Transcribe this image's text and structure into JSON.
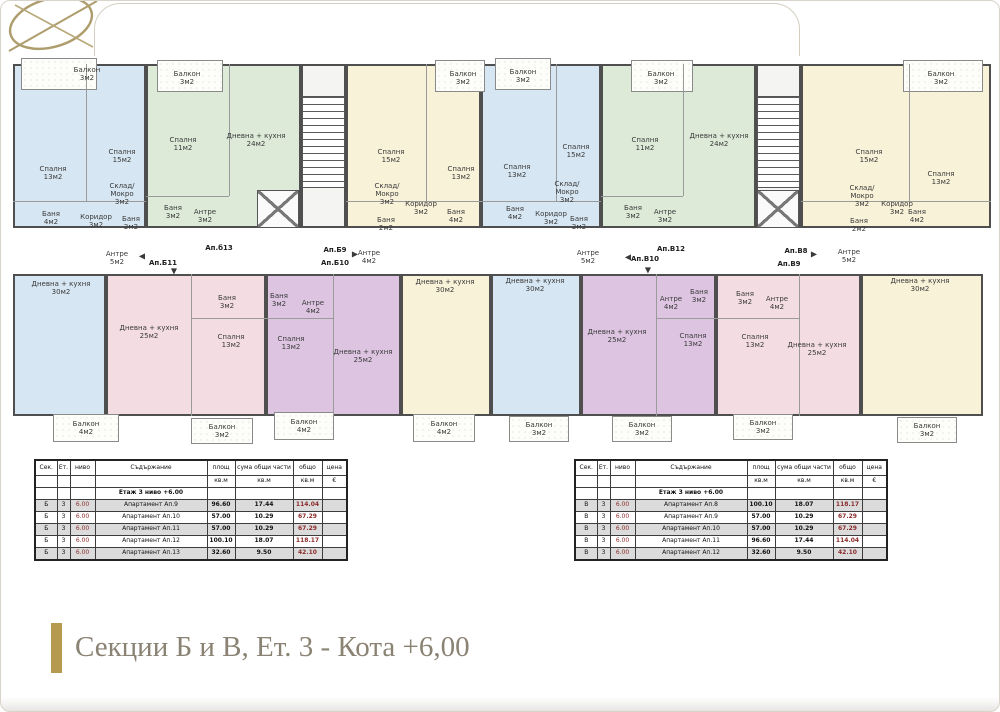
{
  "footer": {
    "title": "Секции Б и В, Ет. 3 - Кота +6,00",
    "accent_gold": "#b69a50"
  },
  "plan": {
    "palette": {
      "blue": "#d6e6f2",
      "green": "#dcead7",
      "yellow": "#f8f2d8",
      "pink": "#f4dde2",
      "purple": "#ddc5e2",
      "wall": "#4f4f4f"
    },
    "blocks": [
      {
        "x": 2,
        "y": 8,
        "w": 133,
        "h": 164,
        "f": "blue"
      },
      {
        "x": 135,
        "y": 8,
        "w": 155,
        "h": 164,
        "f": "green"
      },
      {
        "x": 290,
        "y": 8,
        "w": 45,
        "h": 164,
        "f": "core"
      },
      {
        "x": 335,
        "y": 8,
        "w": 135,
        "h": 164,
        "f": "yellow"
      },
      {
        "x": 470,
        "y": 8,
        "w": 120,
        "h": 164,
        "f": "blue"
      },
      {
        "x": 590,
        "y": 8,
        "w": 155,
        "h": 164,
        "f": "green"
      },
      {
        "x": 745,
        "y": 8,
        "w": 45,
        "h": 164,
        "f": "core"
      },
      {
        "x": 790,
        "y": 8,
        "w": 190,
        "h": 164,
        "f": "yellow"
      },
      {
        "x": 2,
        "y": 218,
        "w": 93,
        "h": 142,
        "f": "blue"
      },
      {
        "x": 95,
        "y": 218,
        "w": 160,
        "h": 142,
        "f": "pink"
      },
      {
        "x": 255,
        "y": 218,
        "w": 135,
        "h": 142,
        "f": "purple"
      },
      {
        "x": 390,
        "y": 218,
        "w": 90,
        "h": 142,
        "f": "yellow"
      },
      {
        "x": 480,
        "y": 218,
        "w": 90,
        "h": 142,
        "f": "blue"
      },
      {
        "x": 570,
        "y": 218,
        "w": 135,
        "h": 142,
        "f": "purple"
      },
      {
        "x": 705,
        "y": 218,
        "w": 145,
        "h": 142,
        "f": "pink"
      },
      {
        "x": 850,
        "y": 218,
        "w": 122,
        "h": 142,
        "f": "yellow"
      }
    ],
    "balconies": [
      {
        "x": 10,
        "y": 2,
        "w": 76,
        "h": 32
      },
      {
        "x": 146,
        "y": 4,
        "w": 66,
        "h": 32
      },
      {
        "x": 424,
        "y": 4,
        "w": 50,
        "h": 32
      },
      {
        "x": 484,
        "y": 2,
        "w": 56,
        "h": 32
      },
      {
        "x": 620,
        "y": 4,
        "w": 62,
        "h": 32
      },
      {
        "x": 892,
        "y": 4,
        "w": 80,
        "h": 32
      },
      {
        "x": 42,
        "y": 358,
        "w": 66,
        "h": 28
      },
      {
        "x": 180,
        "y": 362,
        "w": 62,
        "h": 26
      },
      {
        "x": 263,
        "y": 356,
        "w": 60,
        "h": 28
      },
      {
        "x": 402,
        "y": 358,
        "w": 62,
        "h": 28
      },
      {
        "x": 498,
        "y": 360,
        "w": 60,
        "h": 26
      },
      {
        "x": 601,
        "y": 360,
        "w": 60,
        "h": 26
      },
      {
        "x": 722,
        "y": 358,
        "w": 60,
        "h": 26
      },
      {
        "x": 886,
        "y": 361,
        "w": 60,
        "h": 26
      }
    ],
    "dividers": [
      {
        "x": 75,
        "y": 8,
        "w": 1,
        "h": 137
      },
      {
        "x": 2,
        "y": 145,
        "w": 133,
        "h": 1
      },
      {
        "x": 218,
        "y": 8,
        "w": 1,
        "h": 132
      },
      {
        "x": 135,
        "y": 140,
        "w": 83,
        "h": 1
      },
      {
        "x": 415,
        "y": 8,
        "w": 1,
        "h": 137
      },
      {
        "x": 335,
        "y": 145,
        "w": 135,
        "h": 1
      },
      {
        "x": 545,
        "y": 8,
        "w": 1,
        "h": 137
      },
      {
        "x": 470,
        "y": 145,
        "w": 120,
        "h": 1
      },
      {
        "x": 672,
        "y": 8,
        "w": 1,
        "h": 132
      },
      {
        "x": 590,
        "y": 140,
        "w": 82,
        "h": 1
      },
      {
        "x": 898,
        "y": 8,
        "w": 1,
        "h": 137
      },
      {
        "x": 790,
        "y": 145,
        "w": 190,
        "h": 1
      },
      {
        "x": 180,
        "y": 218,
        "w": 1,
        "h": 142
      },
      {
        "x": 180,
        "y": 262,
        "w": 75,
        "h": 1
      },
      {
        "x": 322,
        "y": 218,
        "w": 1,
        "h": 142
      },
      {
        "x": 255,
        "y": 262,
        "w": 67,
        "h": 1
      },
      {
        "x": 645,
        "y": 218,
        "w": 1,
        "h": 142
      },
      {
        "x": 645,
        "y": 262,
        "w": 60,
        "h": 1
      },
      {
        "x": 788,
        "y": 218,
        "w": 1,
        "h": 142
      },
      {
        "x": 705,
        "y": 262,
        "w": 83,
        "h": 1
      }
    ],
    "stairs": [
      {
        "x": 291,
        "y": 40,
        "w": 43,
        "h": 92
      },
      {
        "x": 746,
        "y": 40,
        "w": 43,
        "h": 92
      }
    ],
    "elevators": [
      {
        "x": 246,
        "y": 134,
        "w": 42,
        "h": 38
      },
      {
        "x": 746,
        "y": 134,
        "w": 42,
        "h": 38
      }
    ],
    "labels": [
      {
        "t": "Балкон\n3м2",
        "x": 76,
        "y": 18
      },
      {
        "t": "Спалня\n13м2",
        "x": 42,
        "y": 117
      },
      {
        "t": "Спалня\n15м2",
        "x": 111,
        "y": 100
      },
      {
        "t": "Склад/\nМокро\n3м2",
        "x": 111,
        "y": 138
      },
      {
        "t": "Баня\n4м2",
        "x": 40,
        "y": 162
      },
      {
        "t": "Коридор\n3м2",
        "x": 85,
        "y": 165
      },
      {
        "t": "Баня\n2м2",
        "x": 120,
        "y": 167
      },
      {
        "t": "Балкон\n3м2",
        "x": 176,
        "y": 22
      },
      {
        "t": "Спалня\n11м2",
        "x": 172,
        "y": 88
      },
      {
        "t": "Дневна + кухня\n24м2",
        "x": 245,
        "y": 84
      },
      {
        "t": "Баня\n3м2",
        "x": 162,
        "y": 156
      },
      {
        "t": "Антре\n3м2",
        "x": 194,
        "y": 160
      },
      {
        "t": "Спалня\n15м2",
        "x": 380,
        "y": 100
      },
      {
        "t": "Склад/\nМокро\n3м2",
        "x": 376,
        "y": 138
      },
      {
        "t": "Коридор\n3м2",
        "x": 410,
        "y": 152
      },
      {
        "t": "Баня\n2м2",
        "x": 375,
        "y": 168
      },
      {
        "t": "Спалня\n13м2",
        "x": 450,
        "y": 117
      },
      {
        "t": "Баня\n4м2",
        "x": 445,
        "y": 160
      },
      {
        "t": "Балкон\n3м2",
        "x": 452,
        "y": 22
      },
      {
        "t": "Балкон\n3м2",
        "x": 512,
        "y": 20
      },
      {
        "t": "Спалня\n13м2",
        "x": 506,
        "y": 115
      },
      {
        "t": "Спалня\n15м2",
        "x": 565,
        "y": 95
      },
      {
        "t": "Склад/\nМокро\n3м2",
        "x": 556,
        "y": 136
      },
      {
        "t": "Баня\n4м2",
        "x": 504,
        "y": 157
      },
      {
        "t": "Коридор\n3м2",
        "x": 540,
        "y": 162
      },
      {
        "t": "Баня\n2м2",
        "x": 568,
        "y": 167
      },
      {
        "t": "Балкон\n3м2",
        "x": 650,
        "y": 22
      },
      {
        "t": "Спалня\n11м2",
        "x": 634,
        "y": 88
      },
      {
        "t": "Дневна + кухня\n24м2",
        "x": 708,
        "y": 84
      },
      {
        "t": "Баня\n3м2",
        "x": 622,
        "y": 156
      },
      {
        "t": "Антре\n3м2",
        "x": 654,
        "y": 160
      },
      {
        "t": "Балкон\n3м2",
        "x": 930,
        "y": 22
      },
      {
        "t": "Спалня\n15м2",
        "x": 858,
        "y": 100
      },
      {
        "t": "Спалня\n13м2",
        "x": 930,
        "y": 122
      },
      {
        "t": "Склад/\nМокро\n3м2",
        "x": 851,
        "y": 140
      },
      {
        "t": "Коридор\n3м2",
        "x": 886,
        "y": 152
      },
      {
        "t": "Баня\n2м2",
        "x": 848,
        "y": 169
      },
      {
        "t": "Баня\n4м2",
        "x": 906,
        "y": 160
      },
      {
        "t": "Антре\n5м2",
        "x": 106,
        "y": 202
      },
      {
        "t": "Ап.Б11",
        "x": 152,
        "y": 207,
        "b": 1
      },
      {
        "t": "Ап.б13",
        "x": 208,
        "y": 192,
        "b": 1
      },
      {
        "t": "Ап.Б9",
        "x": 324,
        "y": 194,
        "b": 1
      },
      {
        "t": "Ап.Б10",
        "x": 324,
        "y": 207,
        "b": 1
      },
      {
        "t": "Антре\n4м2",
        "x": 358,
        "y": 201
      },
      {
        "t": "Антре\n5м2",
        "x": 577,
        "y": 201
      },
      {
        "t": "Ап.В10",
        "x": 634,
        "y": 203,
        "b": 1
      },
      {
        "t": "Ап.В12",
        "x": 660,
        "y": 193,
        "b": 1
      },
      {
        "t": "Ап.В8",
        "x": 785,
        "y": 195,
        "b": 1
      },
      {
        "t": "Ап.В9",
        "x": 778,
        "y": 208,
        "b": 1
      },
      {
        "t": "Антре\n5м2",
        "x": 838,
        "y": 200
      },
      {
        "t": "◀",
        "x": 131,
        "y": 200,
        "fs": 8
      },
      {
        "t": "▼",
        "x": 163,
        "y": 215,
        "fs": 8
      },
      {
        "t": "▶",
        "x": 344,
        "y": 198,
        "fs": 8
      },
      {
        "t": "◀",
        "x": 617,
        "y": 201,
        "fs": 8
      },
      {
        "t": "▼",
        "x": 637,
        "y": 214,
        "fs": 8
      },
      {
        "t": "▶",
        "x": 803,
        "y": 198,
        "fs": 8
      },
      {
        "t": "Дневна + кухня\n30м2",
        "x": 50,
        "y": 232
      },
      {
        "t": "Балкон\n4м2",
        "x": 75,
        "y": 372
      },
      {
        "t": "Дневна + кухня\n25м2",
        "x": 138,
        "y": 276
      },
      {
        "t": "Баня\n3м2",
        "x": 216,
        "y": 246
      },
      {
        "t": "Спалня\n13м2",
        "x": 220,
        "y": 285
      },
      {
        "t": "Балкон\n3м2",
        "x": 211,
        "y": 375
      },
      {
        "t": "Баня\n3м2",
        "x": 268,
        "y": 244
      },
      {
        "t": "Антре\n4м2",
        "x": 302,
        "y": 251
      },
      {
        "t": "Спалня\n13м2",
        "x": 280,
        "y": 287
      },
      {
        "t": "Дневна + кухня\n25м2",
        "x": 352,
        "y": 300
      },
      {
        "t": "Балкон\n4м2",
        "x": 293,
        "y": 370
      },
      {
        "t": "Дневна + кухня\n30м2",
        "x": 434,
        "y": 230
      },
      {
        "t": "Балкон\n4м2",
        "x": 433,
        "y": 372
      },
      {
        "t": "Дневна + кухня\n30м2",
        "x": 524,
        "y": 229
      },
      {
        "t": "Балкон\n3м2",
        "x": 528,
        "y": 373
      },
      {
        "t": "Дневна + кухня\n25м2",
        "x": 606,
        "y": 280
      },
      {
        "t": "Антре\n4м2",
        "x": 660,
        "y": 247
      },
      {
        "t": "Баня\n3м2",
        "x": 688,
        "y": 240
      },
      {
        "t": "Спалня\n13м2",
        "x": 682,
        "y": 284
      },
      {
        "t": "Балкон\n3м2",
        "x": 631,
        "y": 373
      },
      {
        "t": "Баня\n3м2",
        "x": 734,
        "y": 242
      },
      {
        "t": "Антре\n4м2",
        "x": 766,
        "y": 247
      },
      {
        "t": "Спалня\n13м2",
        "x": 744,
        "y": 285
      },
      {
        "t": "Дневна + кухня\n25м2",
        "x": 806,
        "y": 293
      },
      {
        "t": "Балкон\n3м2",
        "x": 752,
        "y": 371
      },
      {
        "t": "Дневна + кухня\n30м2",
        "x": 909,
        "y": 229
      },
      {
        "t": "Балкон\n3м2",
        "x": 916,
        "y": 374
      }
    ]
  },
  "tables": [
    {
      "x": 33,
      "y": 458,
      "headers": [
        "Сек.",
        "Ет.",
        "ниво",
        "Съдържание",
        "площ",
        "сума общи части",
        "общо",
        "цена"
      ],
      "units": [
        "",
        "",
        "",
        "",
        "кв.м",
        "кв.м",
        "кв.м",
        "€"
      ],
      "section_row": "Етаж 3 ниво +6.00",
      "rows": [
        [
          "Б",
          "3",
          "6.00",
          "Апартамент Ап.9",
          "96.60",
          "17.44",
          "114.04",
          ""
        ],
        [
          "Б",
          "3",
          "6.00",
          "Апартамент Ап.10",
          "57.00",
          "10.29",
          "67.29",
          ""
        ],
        [
          "Б",
          "3",
          "6.00",
          "Апартамент Ап.11",
          "57.00",
          "10.29",
          "67.29",
          ""
        ],
        [
          "Б",
          "3",
          "6.00",
          "Апартамент Ап.12",
          "100.10",
          "18.07",
          "118.17",
          ""
        ],
        [
          "Б",
          "3",
          "6.00",
          "Апартамент Ап.13",
          "32.60",
          "9.50",
          "42.10",
          ""
        ]
      ]
    },
    {
      "x": 573,
      "y": 458,
      "headers": [
        "Сек.",
        "Ет.",
        "ниво",
        "Съдържание",
        "площ",
        "сума общи части",
        "общо",
        "цена"
      ],
      "units": [
        "",
        "",
        "",
        "",
        "кв.м",
        "кв.м",
        "кв.м",
        "€"
      ],
      "section_row": "Етаж 3 ниво +6.00",
      "rows": [
        [
          "В",
          "3",
          "6.00",
          "Апартамент Ап.8",
          "100.10",
          "18.07",
          "118.17",
          ""
        ],
        [
          "В",
          "3",
          "6.00",
          "Апартамент Ап.9",
          "57.00",
          "10.29",
          "67.29",
          ""
        ],
        [
          "В",
          "3",
          "6.00",
          "Апартамент Ап.10",
          "57.00",
          "10.29",
          "67.29",
          ""
        ],
        [
          "В",
          "3",
          "6.00",
          "Апартамент Ап.11",
          "96.60",
          "17.44",
          "114.04",
          ""
        ],
        [
          "В",
          "3",
          "6.00",
          "Апартамент Ап.12",
          "32.60",
          "9.50",
          "42.10",
          ""
        ]
      ]
    }
  ]
}
